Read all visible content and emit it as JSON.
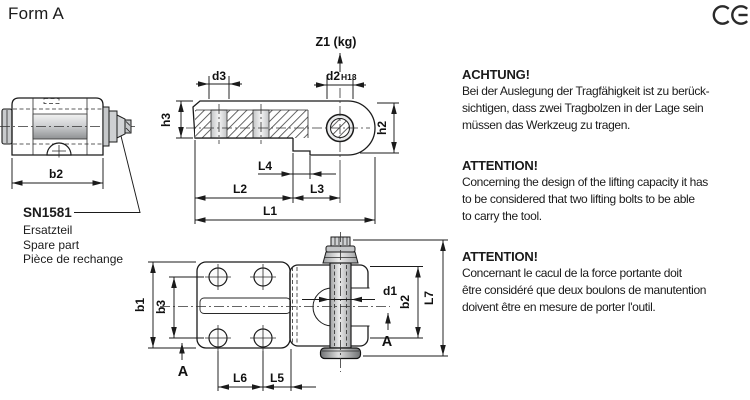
{
  "page": {
    "title": "Form A",
    "ce_mark": "CE"
  },
  "spare_part": {
    "code": "SN1581",
    "labels": [
      "Ersatzteil",
      "Spare part",
      "Pièce de rechange"
    ]
  },
  "dims": {
    "d1": "d1",
    "d2": "d2",
    "d2_tol": "H13",
    "d3": "d3",
    "z1": "Z1 (kg)",
    "h2": "h2",
    "h3": "h3",
    "l1": "L1",
    "l2": "L2",
    "l3": "L3",
    "l4": "L4",
    "l5": "L5",
    "l6": "L6",
    "l7": "L7",
    "b1": "b1",
    "b2": "b2",
    "b3": "b3",
    "section": "A"
  },
  "notices": [
    {
      "heading": "ACHTUNG!",
      "lines": [
        "Bei der Auslegung der Tragfähigkeit ist zu berück-",
        "sichtigen, dass zwei Tragbolzen in der Lage sein",
        "müssen das Werkzeug zu tragen."
      ]
    },
    {
      "heading": "ATTENTION!",
      "lines": [
        "Concerning the design of the lifting capacity it has",
        "to be considered that two lifting bolts to be able",
        "to carry the tool."
      ]
    },
    {
      "heading": "ATTENTION!",
      "lines": [
        "Concernant le cacul de la force portante doit",
        "être considéré que deux boulons de manutention",
        "doivent être en mesure de porter l'outil."
      ]
    }
  ]
}
